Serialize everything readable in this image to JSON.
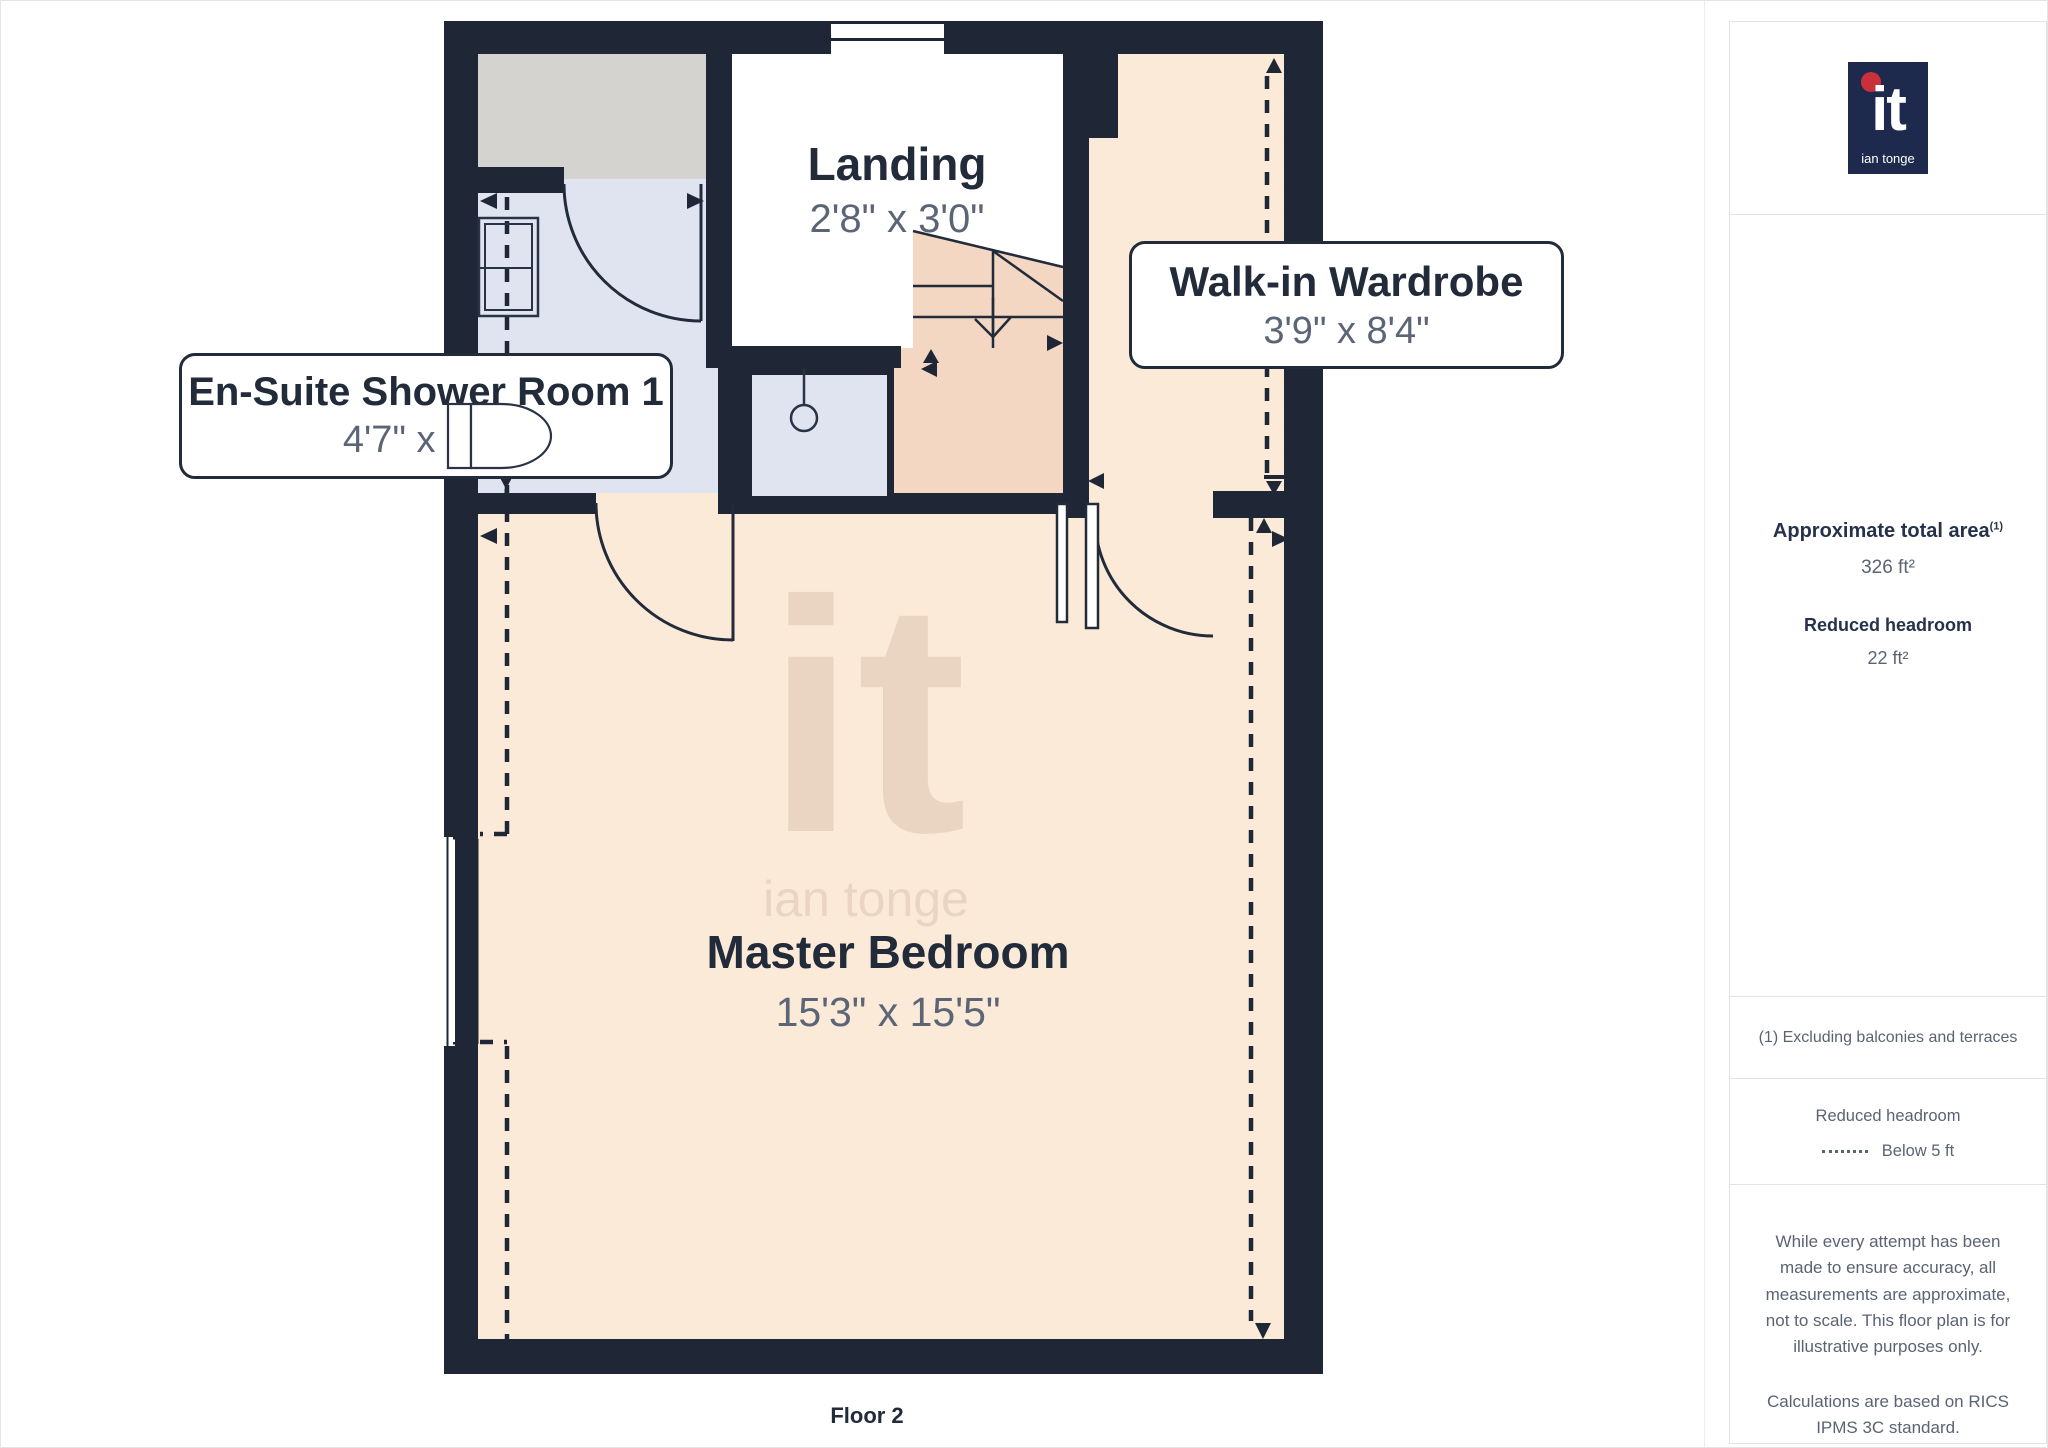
{
  "floor_plan": {
    "floor_label": "Floor 2",
    "watermark": {
      "big": "it",
      "small": "ian tonge"
    },
    "rooms": [
      {
        "name": "Landing",
        "dims": "2'8\" x 3'0\""
      },
      {
        "name": "Walk-in Wardrobe",
        "dims": "3'9\" x 8'4\""
      },
      {
        "name": "En-Suite Shower Room 1",
        "dims": "4'7\" x 5'9\""
      },
      {
        "name": "Master Bedroom",
        "dims": "15'3\" x 15'5\""
      }
    ],
    "colors": {
      "wall": "#1f2736",
      "bedroom_floor": "#fcead9",
      "stairs_floor": "#f3d7c3",
      "ensuite_floor": "#dfe4f0",
      "void_gray": "#d5d3d0",
      "watermark": "#e9d5c1"
    }
  },
  "sidebar": {
    "logo": {
      "big": "it",
      "small": "ian tonge",
      "navy": "#1d2a4d",
      "red": "#c9303a"
    },
    "area_title": "Approximate total area",
    "area_superscript": "(1)",
    "area_value": "326 ft²",
    "headroom_title": "Reduced headroom",
    "headroom_value": "22 ft²",
    "footnote": "(1) Excluding balconies and terraces",
    "legend_title": "Reduced headroom",
    "legend_item": "Below 5 ft",
    "disclaimer1": "While every attempt has been made to ensure accuracy, all measurements are approximate, not to scale. This floor plan is for illustrative purposes only.",
    "disclaimer2": "Calculations are based on RICS IPMS 3C standard.",
    "brand": "GIRAFFE",
    "brand_suffix": "360"
  }
}
